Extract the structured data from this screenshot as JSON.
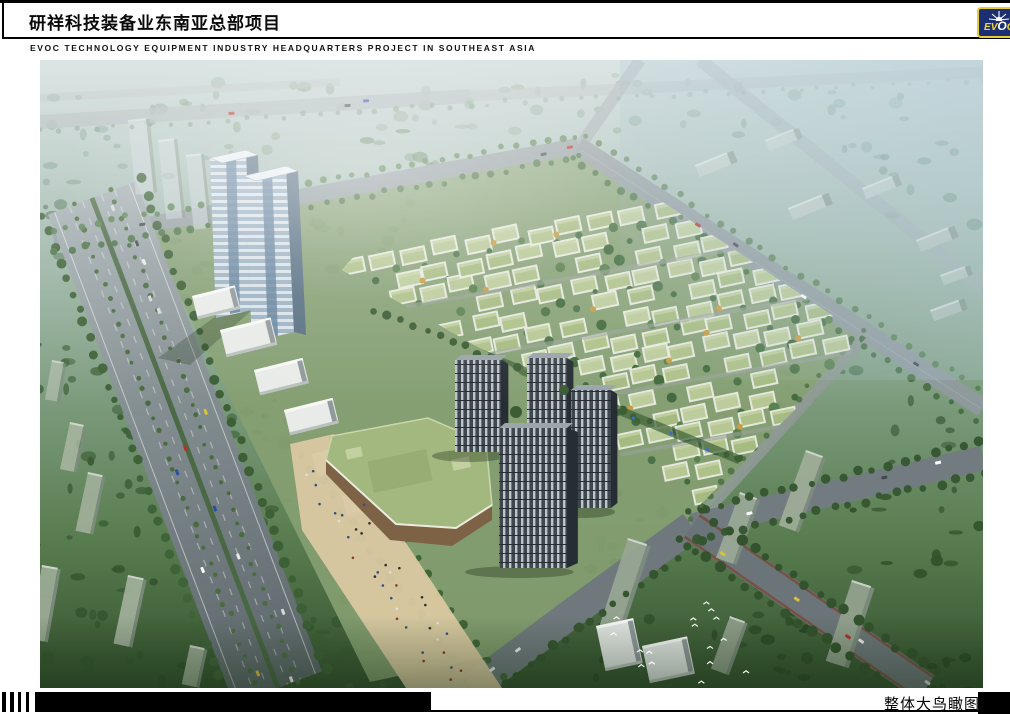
{
  "header": {
    "title_cn": "研祥科技装备业东南亚总部项目",
    "title_en": "EVOC TECHNOLOGY EQUIPMENT INDUSTRY HEADQUARTERS PROJECT IN SOUTHEAST ASIA"
  },
  "logo": {
    "text": "EVOC",
    "bg_color": "#1c2f72",
    "border_color": "#e6cc35",
    "icon": "sunburst-icon"
  },
  "footer": {
    "caption": "整体大鸟瞰图"
  },
  "artwork": {
    "description": "Aerial bird's-eye rendering of the technology industrial park: twin office towers, villa-style workshop field, residential high-rises, green-roof exhibition mall, tree-lined avenues",
    "palette": {
      "haze": "#bccdcd",
      "mid_green": "#7f9e81",
      "dark_green": "#33512e",
      "road": "#8d989c",
      "villa_roof": "#aec189",
      "plaza": "#d9c8a1",
      "tower_glass": "#9db2c2",
      "residential_tower": "#3f474e",
      "mall_roof": "#a2b87e"
    }
  }
}
